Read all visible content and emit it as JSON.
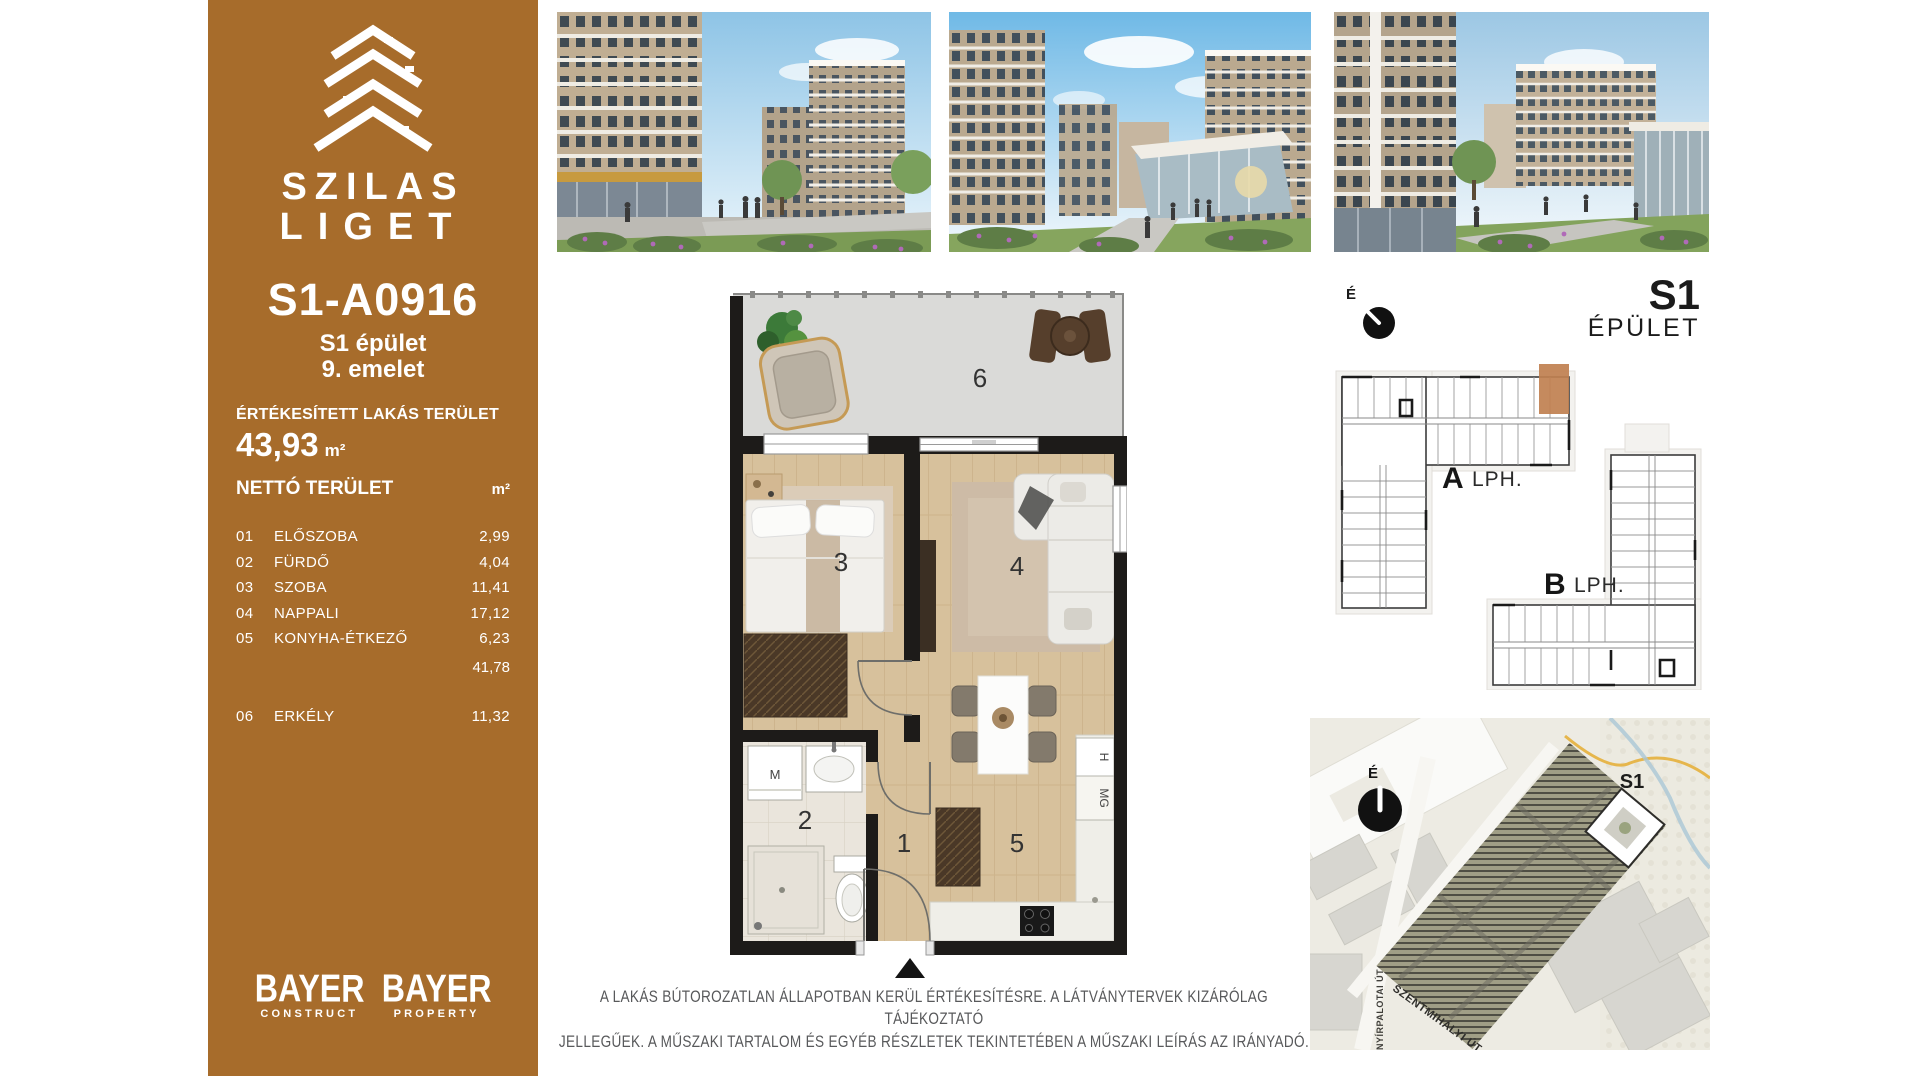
{
  "colors": {
    "sidebar_brown": "#A76C2B",
    "unit_highlight": "#C08050",
    "plan_walls": "#1D1B19",
    "disclaimer_gray": "#58595B"
  },
  "sidebar": {
    "logo_line1": "SZILAS",
    "logo_line2": "LIGET",
    "unit_id": "S1-A0916",
    "building": "S1 épület",
    "floor": "9. emelet",
    "sold_area_label": "ÉRTÉKESÍTETT LAKÁS TERÜLET",
    "sold_area_value": "43,93",
    "area_unit": "m²",
    "net_area_label": "NETTÓ TERÜLET",
    "net_area_unit": "m²",
    "rooms": [
      {
        "num": "01",
        "name": "ELŐSZOBA",
        "area": "2,99"
      },
      {
        "num": "02",
        "name": "FÜRDŐ",
        "area": "4,04"
      },
      {
        "num": "03",
        "name": "SZOBA",
        "area": "11,41"
      },
      {
        "num": "04",
        "name": "NAPPALI",
        "area": "17,12"
      },
      {
        "num": "05",
        "name": "KONYHA-ÉTKEZŐ",
        "area": "6,23"
      }
    ],
    "subtotal": "41,78",
    "balcony_row": {
      "num": "06",
      "name": "ERKÉLY",
      "area": "11,32"
    },
    "brands": [
      {
        "name": "BAYER",
        "sub": "CONSTRUCT"
      },
      {
        "name": "BAYER",
        "sub": "PROPERTY"
      }
    ]
  },
  "top_right": {
    "compass_label": "É",
    "building_code": "S1",
    "building_word": "ÉPÜLET"
  },
  "keyplan": {
    "wing_a": "A",
    "wing_a_suffix": "LPH.",
    "wing_b": "B",
    "wing_b_suffix": "LPH."
  },
  "floorplan": {
    "rooms": {
      "hall": "1",
      "bathroom": "2",
      "bedroom": "3",
      "living": "4",
      "kitchen": "5",
      "balcony": "6"
    },
    "appliances": {
      "washer": "M",
      "fridge": "H",
      "dishwasher": "MG"
    }
  },
  "sitemap": {
    "compass_label": "É",
    "building_tag": "S1",
    "street_vertical": "NYÍRPALOTAI ÚT",
    "street_diagonal": "SZENTMIHÁLYI ÚT"
  },
  "disclaimer": {
    "line1": "A LAKÁS BÚTOROZATLAN ÁLLAPOTBAN KERÜL ÉRTÉKESÍTÉSRE. A LÁTVÁNYTERVEK KIZÁRÓLAG TÁJÉKOZTATÓ",
    "line2": "JELLEGŰEK. A MŰSZAKI TARTALOM ÉS EGYÉB RÉSZLETEK TEKINTETÉBEN A MŰSZAKI LEÍRÁS AZ IRÁNYADÓ."
  }
}
